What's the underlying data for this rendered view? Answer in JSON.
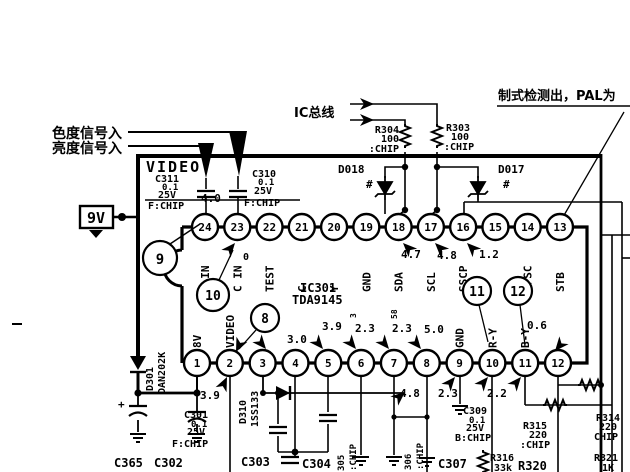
{
  "labels": {
    "chroma_in": "色度信号入",
    "luma_in": "亮度信号入",
    "ic_bus": "IC总线",
    "system_detect": "制式检测出，PAL为",
    "video": "VIDEO",
    "supply": "9V",
    "plus": "+"
  },
  "ic": {
    "ref": "IC301",
    "part": "TDA9145",
    "top_pins": [
      {
        "num": "24",
        "name": "Y IN"
      },
      {
        "num": "23",
        "name": "C IN"
      },
      {
        "num": "22",
        "name": "TEST"
      },
      {
        "num": "21",
        "name": "C"
      },
      {
        "num": "20",
        "name": "Y"
      },
      {
        "num": "19",
        "name": "GND"
      },
      {
        "num": "18",
        "name": "SDA"
      },
      {
        "num": "17",
        "name": "SCL"
      },
      {
        "num": "16",
        "name": "SSCP"
      },
      {
        "num": "15",
        "name": ""
      },
      {
        "num": "14",
        "name": "2FSC"
      },
      {
        "num": "13",
        "name": "STB"
      }
    ],
    "bottom_pins": [
      {
        "num": "1",
        "name": "8V"
      },
      {
        "num": "2",
        "name": "VIDEO"
      },
      {
        "num": "3",
        "name": ""
      },
      {
        "num": "4",
        "name": ""
      },
      {
        "num": "5",
        "name": ""
      },
      {
        "num": "6",
        "name": ""
      },
      {
        "num": "7",
        "name": ""
      },
      {
        "num": "8",
        "name": ""
      },
      {
        "num": "9",
        "name": "GND"
      },
      {
        "num": "10",
        "name": "R-Y"
      },
      {
        "num": "11",
        "name": "B-Y"
      },
      {
        "num": "12",
        "name": ""
      }
    ]
  },
  "test_points": {
    "tp9": "9",
    "tp10": "10",
    "tp8": "8",
    "tp11": "11",
    "tp12": "12"
  },
  "voltages": {
    "pin24": "4.0",
    "pin22": "0",
    "pin18": "4.7",
    "pin17": "4.8",
    "pin16": "1.2",
    "pin4": "3.0",
    "pin5": "3.9",
    "pin6": "2.3",
    "pin7": "2.3",
    "pin8": "5.0",
    "pin11": "0.6",
    "pin1": "3.9",
    "pin8b": "4.8",
    "pin9b": "2.3",
    "pin10b": "2.2"
  },
  "marks": {
    "m1": "3",
    "m2": "58",
    "hash1": "#",
    "hash2": "#"
  },
  "components": {
    "r303": {
      "ref": "R303",
      "value": "100",
      "pkg": ":CHIP"
    },
    "r304": {
      "ref": "R304",
      "value": "100",
      "pkg": ":CHIP"
    },
    "d017": {
      "ref": "D017"
    },
    "d018": {
      "ref": "D018"
    },
    "c310": {
      "ref": "C310",
      "value": "0.1",
      "rating": "25V",
      "pkg": "F:CHIP"
    },
    "c311": {
      "ref": "C311",
      "value": "0.1",
      "rating": "25V",
      "pkg": "F:CHIP"
    },
    "c301": {
      "ref": "C301",
      "value": "0.1",
      "rating": "25V",
      "pkg": "F:CHIP"
    },
    "c309": {
      "ref": "C309",
      "value": "0.1",
      "rating": "25V",
      "pkg": "B:CHIP"
    },
    "d301": {
      "ref": "D301",
      "part": "DAN202K"
    },
    "d310": {
      "ref": "D310",
      "part": "1SS133"
    },
    "c365": {
      "ref": "C365"
    },
    "c302": {
      "ref": "C302"
    },
    "c303": {
      "ref": "C303"
    },
    "c304": {
      "ref": "C304"
    },
    "c305": {
      "ref": "305",
      "pkg": ":CHIP"
    },
    "c306": {
      "ref": "306",
      "pkg": ":CHIP"
    },
    "c307": {
      "ref": "C307"
    },
    "r314": {
      "ref": "R314",
      "value": "220",
      "pkg": "CHIP"
    },
    "r315": {
      "ref": "R315",
      "value": "220",
      "pkg": ":CHIP"
    },
    "r316": {
      "ref": "R316",
      "value": "33k"
    },
    "r320": {
      "ref": "R320"
    },
    "r321": {
      "ref": "R321",
      "value": "1K"
    }
  }
}
